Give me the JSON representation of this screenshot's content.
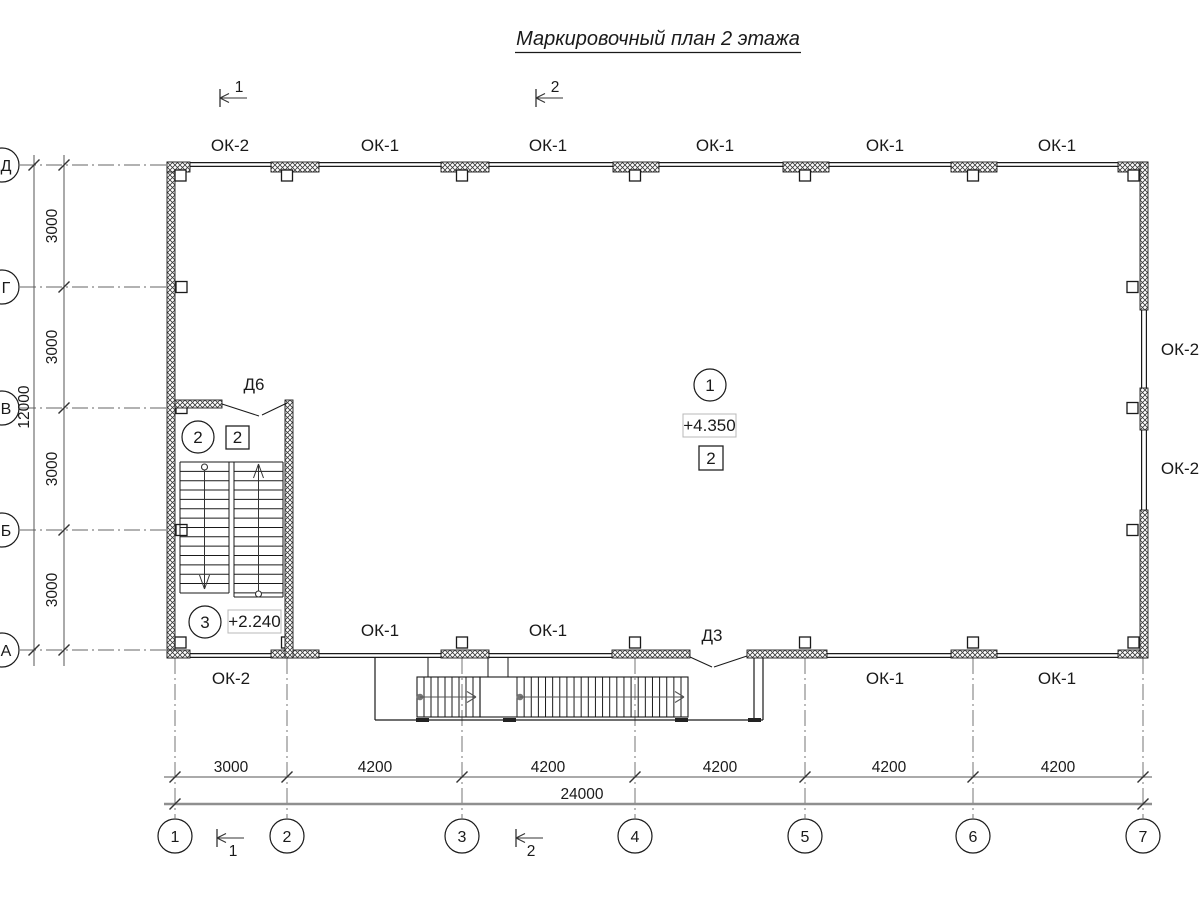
{
  "title": "Маркировочный план 2 этажа",
  "section_markers": {
    "top_1": "1",
    "top_2": "2",
    "bottom_1": "1",
    "bottom_2": "2"
  },
  "windows": {
    "top": [
      "ОК-2",
      "ОК-1",
      "ОК-1",
      "ОК-1",
      "ОК-1",
      "ОК-1"
    ],
    "bottom_inside": [
      "ОК-1",
      "ОК-1"
    ],
    "bottom_outside": [
      "ОК-2",
      "ОК-1",
      "ОК-1"
    ],
    "right": [
      "ОК-2",
      "ОК-2"
    ]
  },
  "doors": {
    "stair_door": "Д6",
    "entrance_door": "Д3"
  },
  "rooms": {
    "hall": {
      "number": "1",
      "elevation": "+4.350",
      "finish_type": "2"
    },
    "stair_upper": {
      "number": "2",
      "finish_type": "2"
    },
    "stair_lower": {
      "number": "3",
      "elevation": "+2.240"
    }
  },
  "axes": {
    "horizontal": [
      "1",
      "2",
      "3",
      "4",
      "5",
      "6",
      "7"
    ],
    "vertical": [
      "Д",
      "Г",
      "В",
      "Б",
      "А"
    ]
  },
  "dimensions": {
    "bottom_segments": [
      "3000",
      "4200",
      "4200",
      "4200",
      "4200",
      "4200"
    ],
    "bottom_total": "24000",
    "left_segments": [
      "3000",
      "3000",
      "3000",
      "3000"
    ],
    "left_total": "12000"
  }
}
